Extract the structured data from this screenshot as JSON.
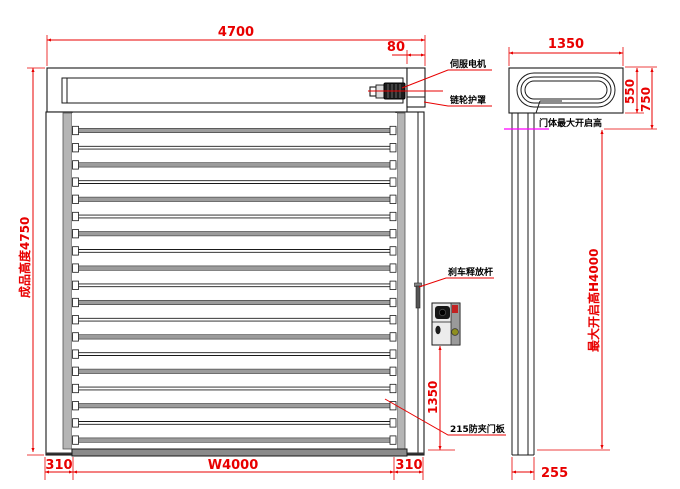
{
  "colors": {
    "dimension_red": "#e80000",
    "highlight_magenta": "#ff00ff",
    "rail_gray": "#b5b5b5",
    "bottom_bar_gray": "#8a8a8a"
  },
  "front_view": {
    "dim_total_width": "4700",
    "dim_motor_side": "80",
    "dim_total_height": "成品高度4750",
    "dim_left_column": "310",
    "dim_opening_width": "W4000",
    "dim_right_column": "310",
    "dim_control_height": "1350",
    "slat_joint_count": 19,
    "labels": {
      "servo_motor": "伺服电机",
      "sprocket_guard": "链轮护罩",
      "brake_release_lever": "刹车释放杆",
      "anti_pinch_panel": "215防夹门板"
    }
  },
  "side_view": {
    "dim_total_depth": "1350",
    "dim_roll_box_height": "550",
    "dim_header_drop": "750",
    "dim_max_opening_height": "最大开启高H4000",
    "label_max_opening": "门体最大开启高",
    "dim_rail_depth": "255"
  }
}
